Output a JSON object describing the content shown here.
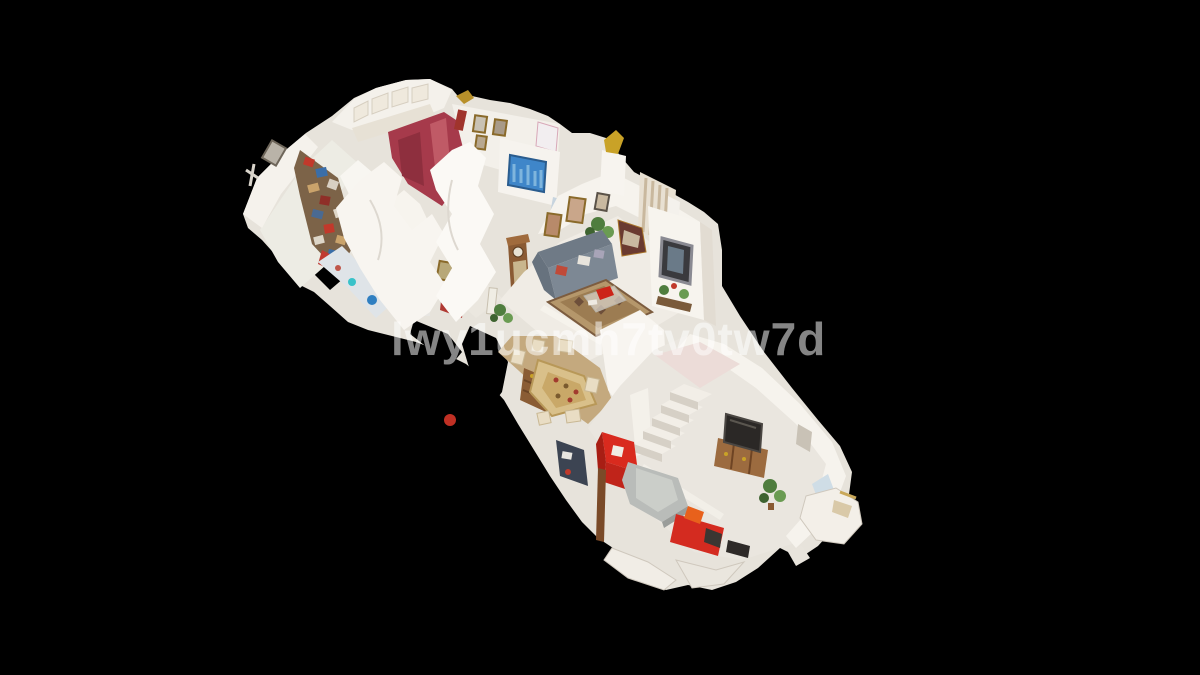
{
  "watermark": {
    "text": "lwy1ucmh7tv0tw7d",
    "color": "rgba(255,255,255,0.52)"
  },
  "scene": {
    "description": "3D dollhouse cutaway view of a furnished single-storey apartment on black background",
    "background_color": "#000000",
    "contents": [
      "storage-room",
      "bathroom",
      "kitchen",
      "picture-hallway",
      "blue-painting",
      "mannequin-hallway",
      "living-room",
      "sofa",
      "oriental-rug",
      "grandfather-clock",
      "ornate-mirror",
      "curtains",
      "dining-table",
      "hutch",
      "stairs",
      "tv-cabinet",
      "red-armchair",
      "ottoman",
      "red-desk",
      "plants",
      "torn-mesh-fragments"
    ],
    "palette": {
      "walls": "#f6f3ed",
      "floor": "#e9e5de",
      "rug": "#b5976b",
      "sofa": "#76818d",
      "accent_red": "#d92a1e",
      "wood": "#8a5a33",
      "tv_screen": "#2b2826",
      "plants": "#4f7d3e",
      "painting_blue": "#3f86c9",
      "kitchen_wall_red": "#a63a4b"
    }
  }
}
